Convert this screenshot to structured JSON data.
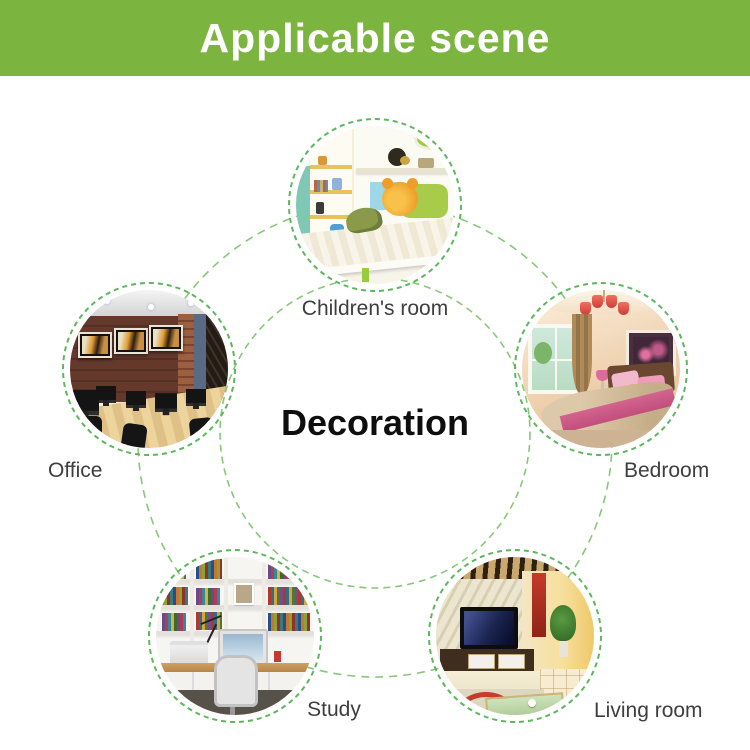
{
  "banner": {
    "title": "Applicable scene",
    "bg_color": "#7cb440",
    "text_color": "#ffffff"
  },
  "center": {
    "title": "Decoration",
    "color": "#0e0e0e"
  },
  "scenes": [
    {
      "id": "childrens-room",
      "label": "Children's room",
      "position": "top"
    },
    {
      "id": "office",
      "label": "Office",
      "position": "left"
    },
    {
      "id": "bedroom",
      "label": "Bedroom",
      "position": "right"
    },
    {
      "id": "study",
      "label": "Study",
      "position": "bottom-left"
    },
    {
      "id": "living-room",
      "label": "Living room",
      "position": "bottom-right"
    }
  ],
  "colors": {
    "ring_green": "#5eb65e",
    "connector_green": "#86c878",
    "label_gray": "#3e3e3e"
  }
}
